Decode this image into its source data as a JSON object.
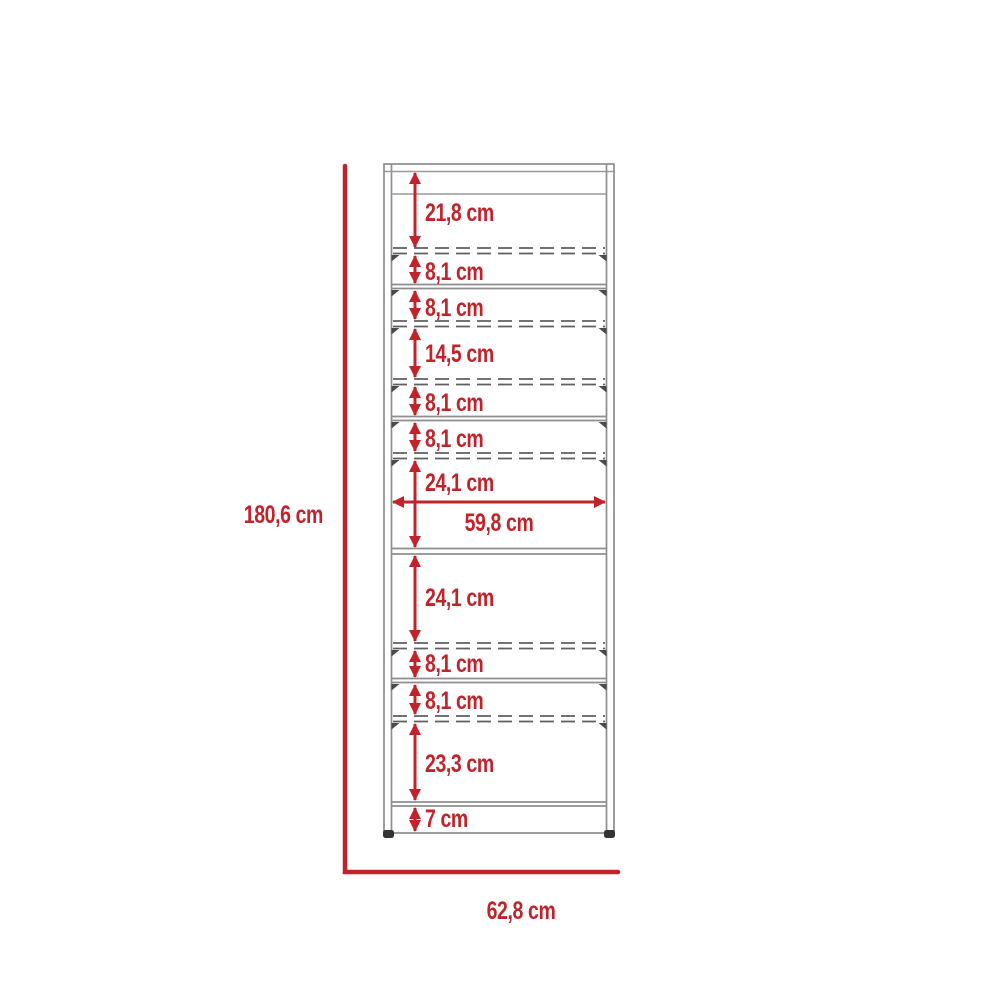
{
  "diagram": {
    "type": "furniture-dimension-diagram",
    "unit": "cm",
    "overall_height": {
      "value": 180.6,
      "label": "180,6 cm"
    },
    "overall_width": {
      "value": 62.8,
      "label": "62,8 cm"
    },
    "inner_width": {
      "value": 59.8,
      "label": "59,8 cm"
    },
    "vertical_segments": [
      {
        "value": 21.8,
        "label": "21,8 cm"
      },
      {
        "value": 8.1,
        "label": "8,1 cm"
      },
      {
        "value": 8.1,
        "label": "8,1 cm"
      },
      {
        "value": 14.5,
        "label": "14,5 cm"
      },
      {
        "value": 8.1,
        "label": "8,1 cm"
      },
      {
        "value": 8.1,
        "label": "8,1 cm"
      },
      {
        "value": 24.1,
        "label": "24,1 cm"
      },
      {
        "value": 24.1,
        "label": "24,1 cm"
      },
      {
        "value": 8.1,
        "label": "8,1 cm"
      },
      {
        "value": 8.1,
        "label": "8,1 cm"
      },
      {
        "value": 23.3,
        "label": "23,3 cm"
      },
      {
        "value": 7,
        "label": "7 cm"
      }
    ],
    "colors": {
      "dimension_red": "#c1232b",
      "cabinet_outline_gray": "#8e8e8e",
      "dashed_shelf_gray": "#5f5f5f",
      "foot_dark": "#333333",
      "background": "#ffffff"
    }
  }
}
